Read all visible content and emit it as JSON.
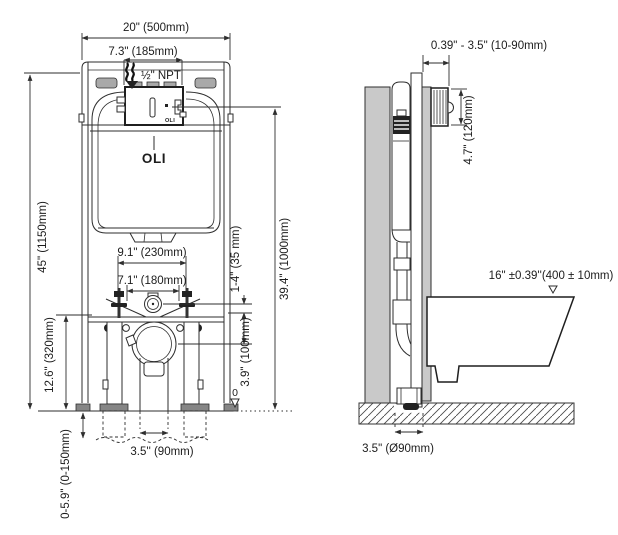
{
  "drawing": {
    "front": {
      "dim_width_outer": "20\" (500mm)",
      "dim_width_plate": "7.3\" (185mm)",
      "supply_label": "½\" NPT",
      "brand": "OLI",
      "brand_plate": "OLI",
      "dim_height_frame": "45\" (1150mm)",
      "dim_height_outlet": "12.6\" (320mm)",
      "dim_bolt_spacing": "9.1\" (230mm)",
      "dim_fixing_spacing": "7.1\" (180mm)",
      "dim_offset_small": "1-4\" (35 mm)",
      "dim_height_plate": "39.4\" (1000mm)",
      "dim_drain_offset": "3.9\" (100mm)",
      "dim_feet_range": "0-5.9\" (0-150mm)",
      "dim_drain_width": "3.5'' (90mm)",
      "floor_datum": "0"
    },
    "side": {
      "dim_wall_thickness": "0.39\" - 3.5\" (10-90mm)",
      "dim_plate_height": "4.7\" (120mm)",
      "dim_bowl_height": "16\" ±0.39''(400 ± 10mm)",
      "dim_drain_diameter": "3.5\" (Ø90mm)"
    }
  }
}
